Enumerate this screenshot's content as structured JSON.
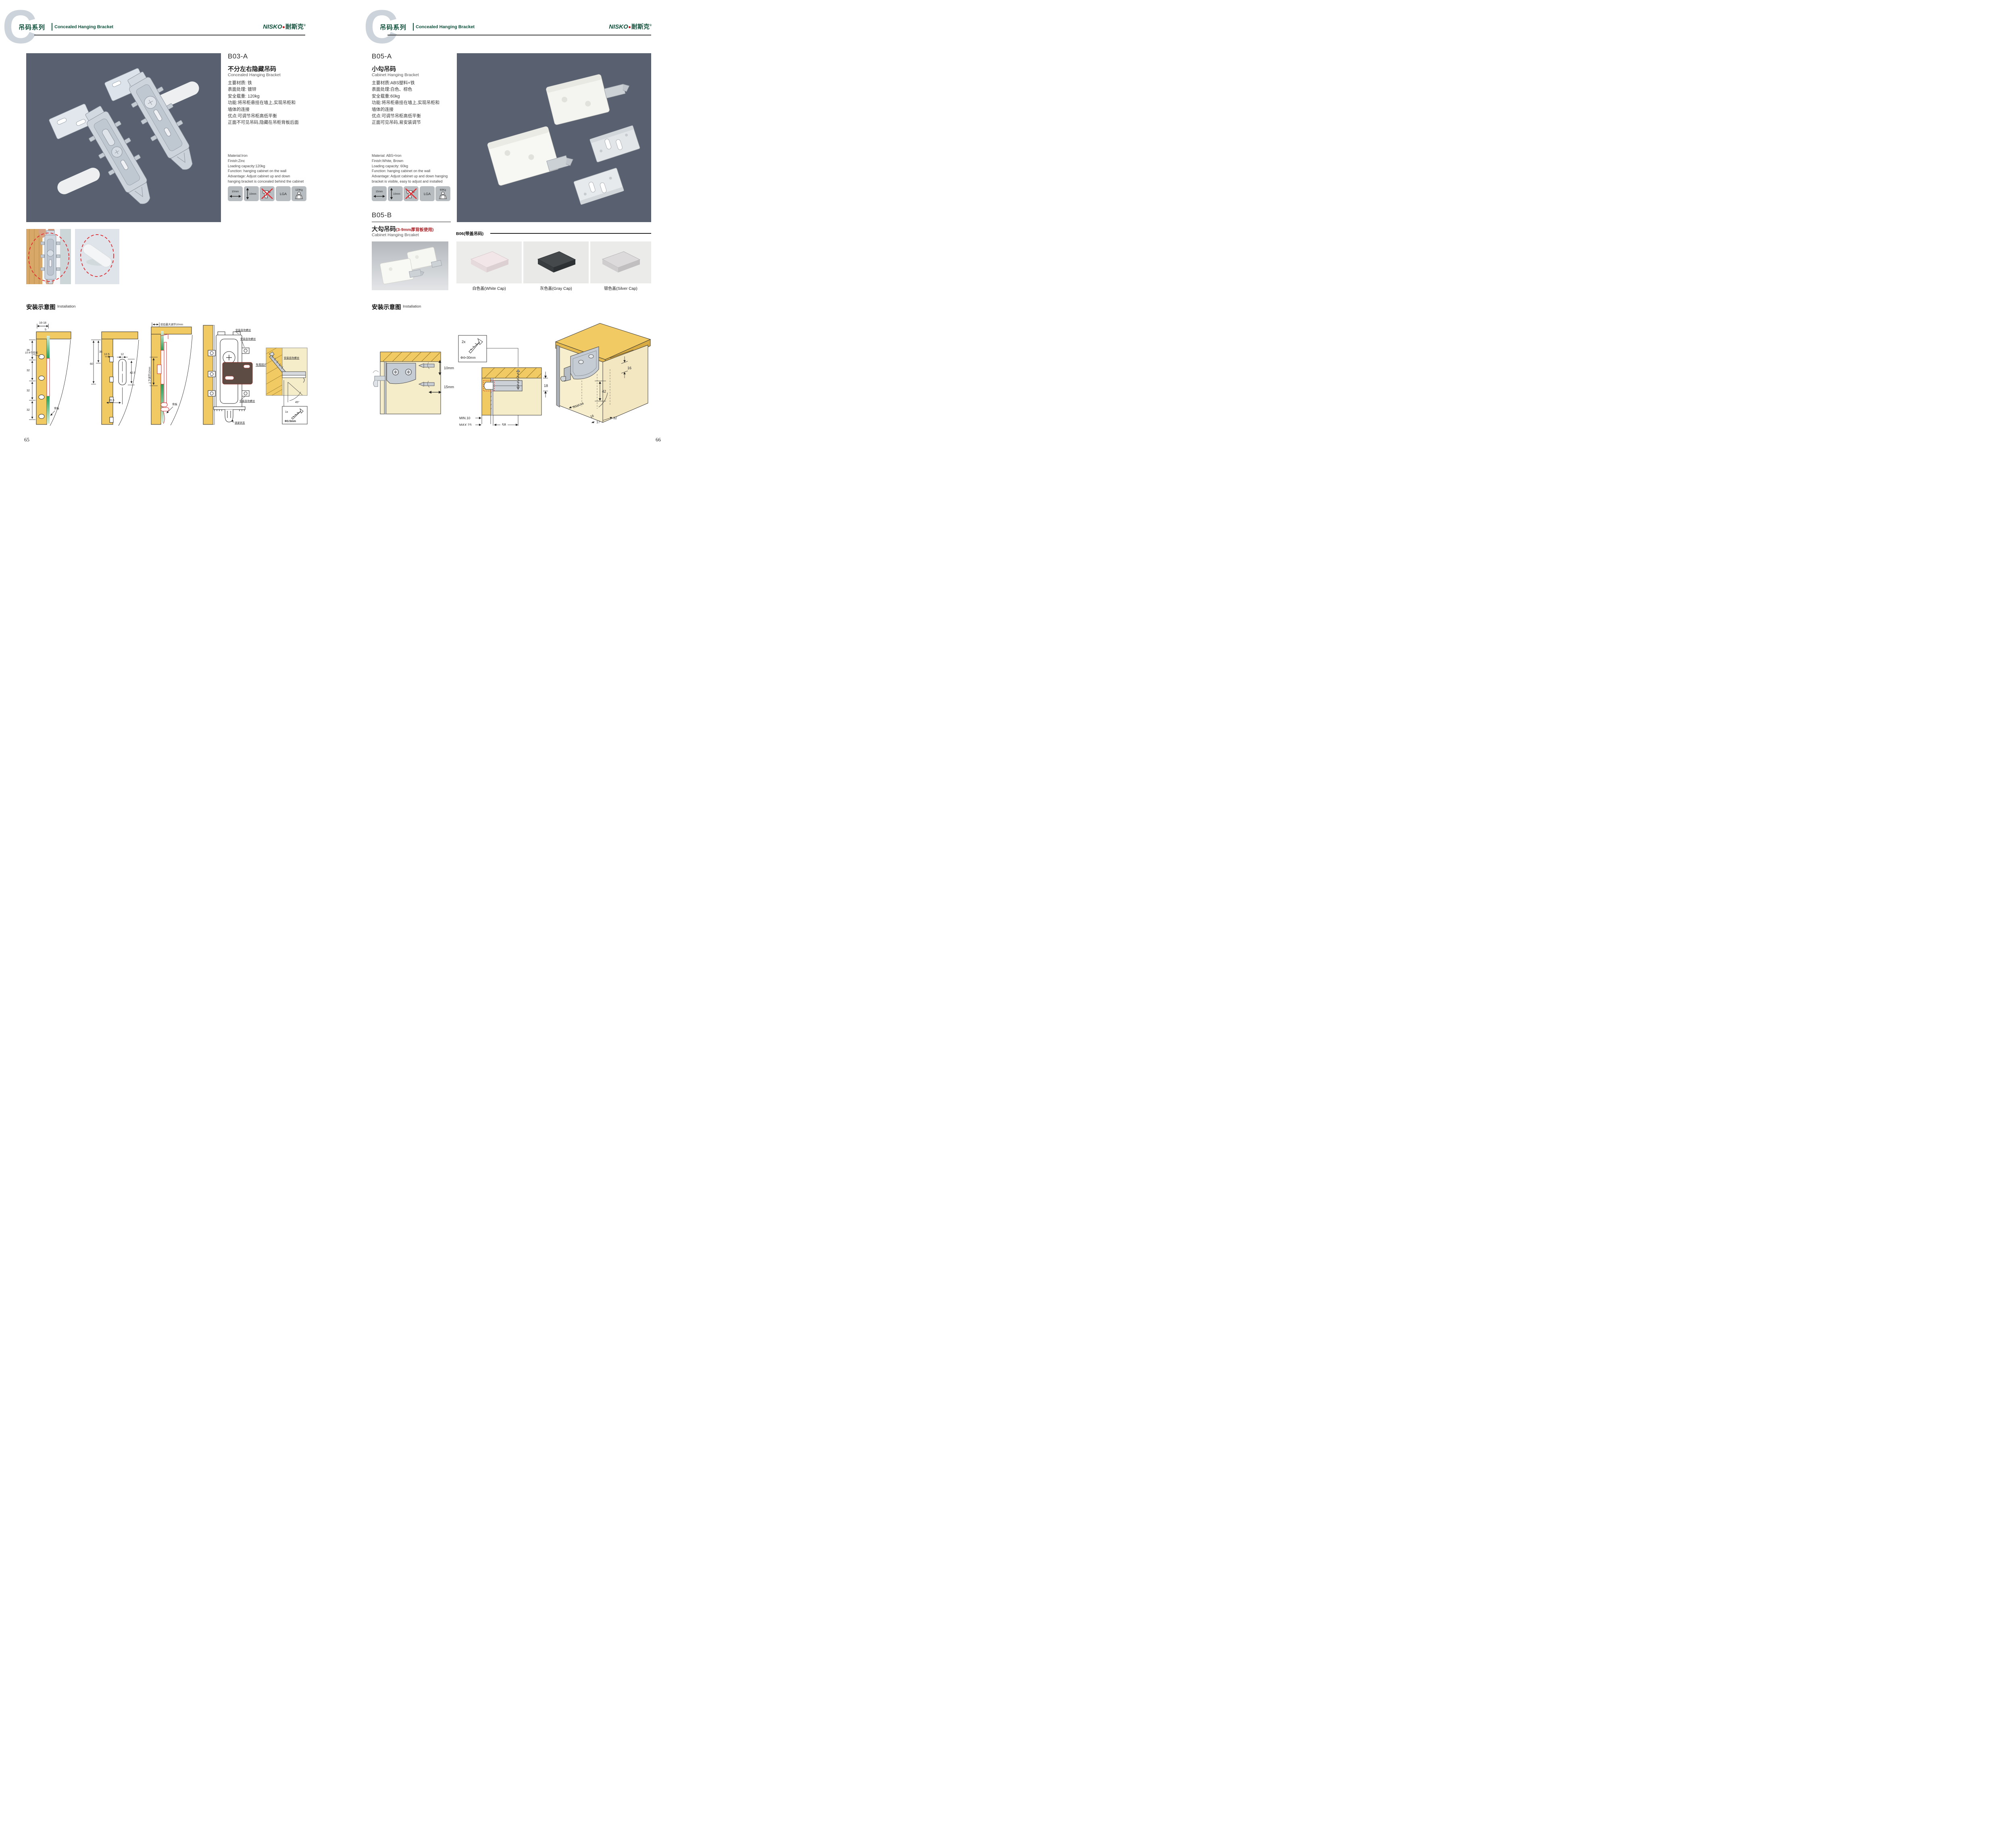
{
  "header": {
    "watermark": "C",
    "series_cn": "吊码系列",
    "series_en": "Concealed Hanging Bracket"
  },
  "brand": {
    "logo_text": "NISKO",
    "logo_cn": "耐斯克",
    "registered": "®"
  },
  "colors": {
    "brand_green": "#0e523a",
    "accent_red": "#c8161d",
    "photo_bg": "#59606f",
    "icon_tile_bg": "#b6bcc0"
  },
  "left_page": {
    "page_number": "65",
    "product": {
      "code": "B03-A",
      "name_cn": "不分左右隐藏吊码",
      "name_en": "Concealed Hanging Bracket",
      "specs_cn": [
        "主要材质: 铁",
        "表面处理: 镀锌",
        "安全载重: 120kg",
        "功能:将吊柜悬挂在墙上,实现吊柜和",
        "墙体的连接",
        "优点:可调节吊柜高低平衡",
        "正面不可见吊码,隐藏在吊柜背板后面"
      ],
      "specs_en": [
        "Material:Iron",
        "Finish:Zinc",
        "Loading capacity:120kg",
        "Function: hanging cabinet on the wall",
        "Advantage: Adjust cabinet up and down",
        "hanging bracket is concealed behind the cabinet"
      ]
    },
    "icons": {
      "width": "10mm",
      "height": "10mm",
      "lga": "LGA",
      "load": "120Kg"
    },
    "installation": {
      "title_cn": "安装示意图",
      "title_en": "Installation"
    },
    "diagram1": {
      "dim_top": "16-18",
      "dim_top_small": "5",
      "dim_a": "35",
      "dim_b": "32",
      "dim_c": "32",
      "dim_d": "32",
      "callout_holes": "10-4个均布",
      "callout_back": "背板"
    },
    "diagram2": {
      "dim_left_a": "60",
      "dim_left_b": "35",
      "dim_offset": "12.5",
      "dim_slot_w": "12",
      "dim_slot_h": "42.5",
      "dim_bottom": "20.5"
    },
    "diagram3": {
      "label_top": "前后最大调节10mm",
      "label_left": "上下调节10mm",
      "callout_back": "背板"
    },
    "diagram4": {
      "screw_top": "安装自攻螺丝",
      "screw_top2": "安装自攻螺丝",
      "screw_bottom": "安装自攻螺丝",
      "lock_state": "锁紧状态",
      "plate": "专用挂片"
    },
    "inset": {
      "screw_label": "安装自攻螺丝",
      "angle": "45°",
      "qty": "1x",
      "dia": "Φ3.5mm"
    }
  },
  "right_page": {
    "page_number": "66",
    "product_a": {
      "code": "B05-A",
      "name_cn": "小勾吊码",
      "name_en": "Cabinet Hanging Bracket",
      "specs_cn": [
        "主要材质:ABS塑料+铁",
        "表面处理:白色、棕色",
        "安全载重:60kg",
        "功能:将吊柜悬挂在墙上,实现吊柜和",
        "墙体的连接",
        "优点:可调节吊柜高低平衡",
        "正面可见吊码,易安装调节"
      ],
      "specs_en": [
        "Material: ABS+Iron",
        "Finish:White, Brown",
        "Loading capacity: 60kg",
        "Function: hanging cabinet on the wall",
        "Advantage: Adjust cabinet up and down hanging",
        "bracket is visible, easy to adjust and installed"
      ]
    },
    "icons": {
      "width": "15mm",
      "height": "10mm",
      "lga": "LGA",
      "load": "60Kg"
    },
    "product_b": {
      "code": "B05-B",
      "name_cn": "大勾吊码",
      "name_note": "(3-9mm厚背板使用)",
      "name_en": "Cabinet Hanging Brcaket"
    },
    "b06": {
      "title": "B06(带盖吊码)",
      "caps": [
        "白色盖(White Cap)",
        "灰色盖(Gray Cap)",
        "银色盖(Silver Cap)"
      ]
    },
    "installation": {
      "title_cn": "安装示意图",
      "title_en": "Installation"
    },
    "diagram1": {
      "dim_v": "10mm",
      "dim_h": "15mm"
    },
    "diagram2": {
      "qty": "2x",
      "dia": "Φ4×30mm",
      "dim_depth": "18",
      "dim_min": "MIN.10",
      "dim_max": "MAX.23",
      "dim_dist": "58"
    },
    "diagram3": {
      "dim_top": "16",
      "dim_height": "42",
      "dim_radius": "RMAX4",
      "dim_r16": "16",
      "dim_17": "17",
      "dim_32": "32"
    }
  }
}
